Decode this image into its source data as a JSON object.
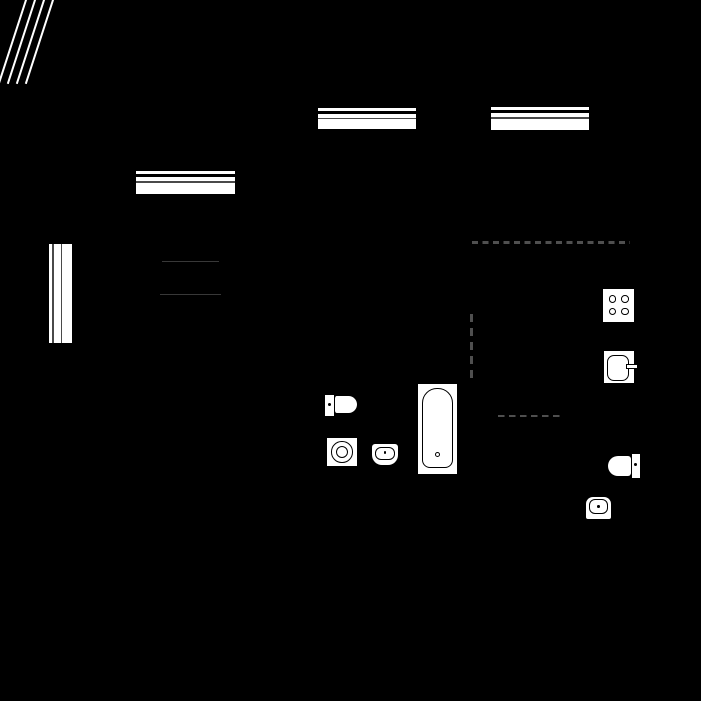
{
  "plan": {
    "type": "apartment-floor-plan",
    "colors": {
      "bg": "#000000",
      "fx": "#ffffff",
      "line": "#000000",
      "gap": "#4a4a4a",
      "dash": "#4f4f4f",
      "furn": "#383838"
    },
    "corner_hatch": {
      "line_count": 4
    },
    "windows": [
      {
        "id": "window-top-center",
        "orientation": "horizontal"
      },
      {
        "id": "window-top-right",
        "orientation": "horizontal"
      },
      {
        "id": "window-left-room",
        "orientation": "horizontal"
      },
      {
        "id": "window-left-wall",
        "orientation": "vertical"
      }
    ],
    "furniture": [
      {
        "id": "table-edge-upper"
      },
      {
        "id": "table-edge-lower"
      }
    ],
    "zone_dividers": [
      {
        "id": "dashed-line-horizontal-long"
      },
      {
        "id": "dashed-line-vertical"
      },
      {
        "id": "dashed-line-horizontal-short"
      }
    ],
    "fixtures": [
      {
        "id": "stove",
        "room": "kitchen",
        "burners": 4
      },
      {
        "id": "kitchen-sink",
        "room": "kitchen",
        "has_faucet": true
      },
      {
        "id": "toilet",
        "room": "bathroom"
      },
      {
        "id": "washing-machine",
        "room": "bathroom"
      },
      {
        "id": "basin",
        "room": "bathroom"
      },
      {
        "id": "bathtub",
        "room": "bathroom"
      },
      {
        "id": "toilet",
        "room": "wc"
      },
      {
        "id": "basin",
        "room": "wc"
      }
    ]
  }
}
